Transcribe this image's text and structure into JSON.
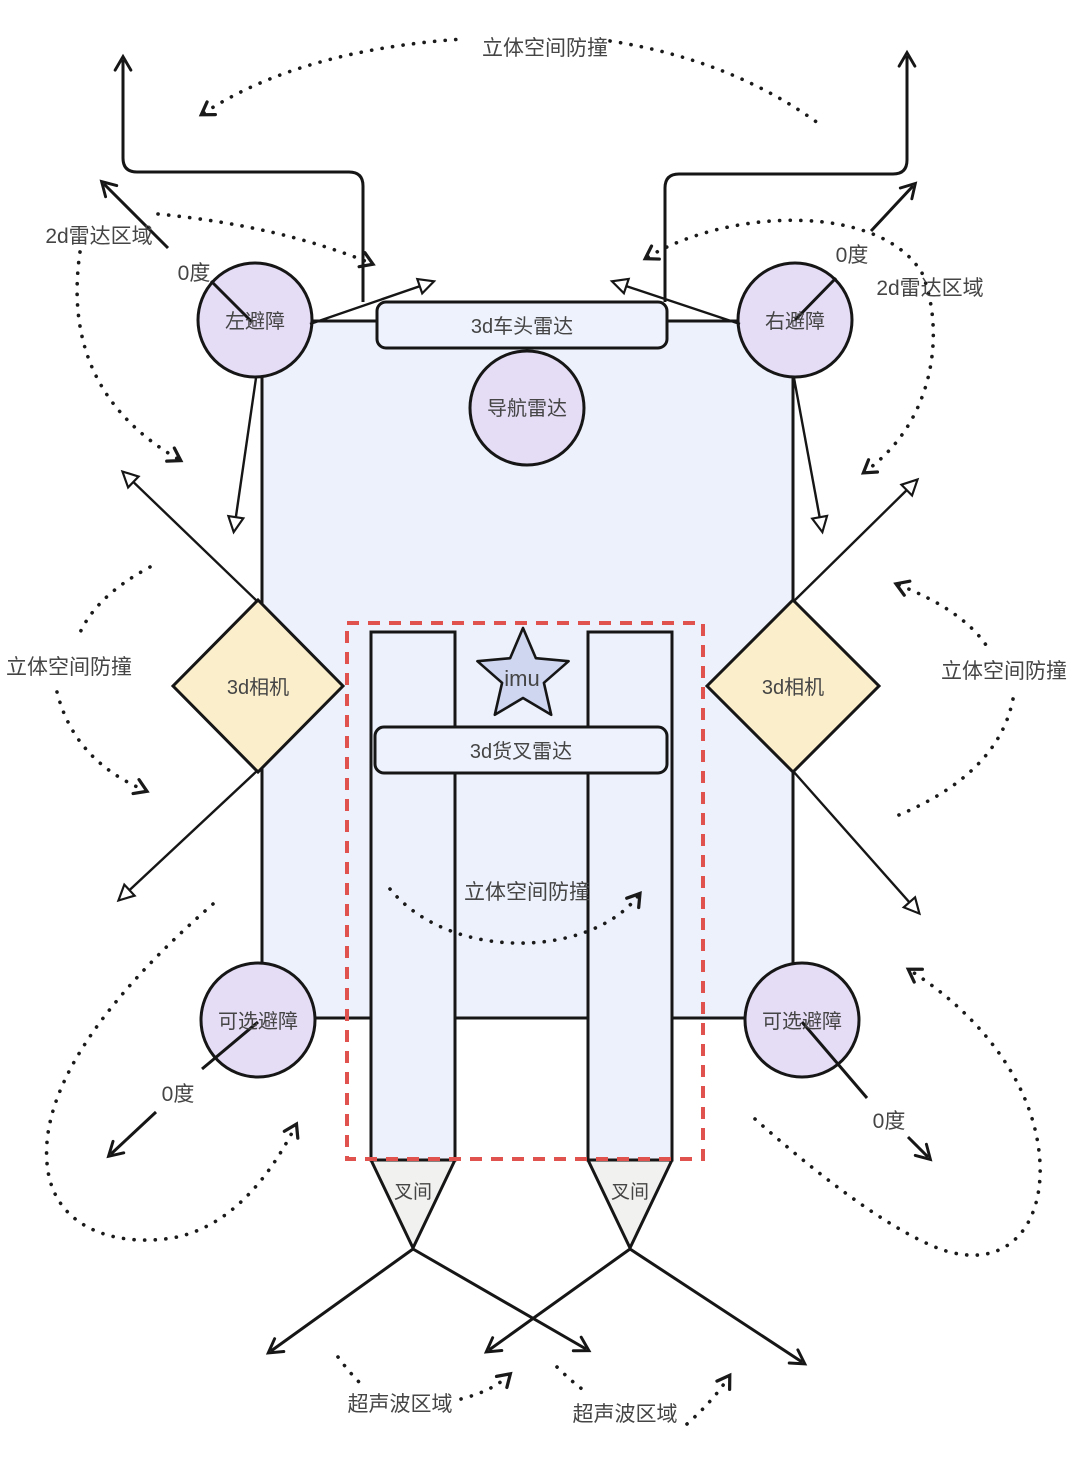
{
  "diagram": {
    "top": {
      "space_collision": "立体空间防撞",
      "radar2d_left": "2d雷达区域",
      "radar2d_right": "2d雷达区域",
      "zero_left": "0度",
      "zero_right": "0度"
    },
    "sensors": {
      "left_avoid": "左避障",
      "right_avoid": "右避障",
      "head_radar": "3d车头雷达",
      "nav_radar": "导航雷达",
      "camera_left": "3d相机",
      "camera_right": "3d相机",
      "imu": "imu",
      "fork_radar": "3d货叉雷达",
      "optional_left": "可选避障",
      "optional_right": "可选避障"
    },
    "middle": {
      "space_left": "立体空间防撞",
      "space_right": "立体空间防撞",
      "space_fork": "立体空间防撞"
    },
    "bottom": {
      "zero_left": "0度",
      "zero_right": "0度",
      "fork_gap_left": "叉间",
      "fork_gap_right": "叉间",
      "ultrasonic_left": "超声波区域",
      "ultrasonic_right": "超声波区域"
    }
  },
  "colors": {
    "body": "#edf1fb",
    "panel": "#eef2fc",
    "node": "#e5dcf6",
    "camera": "#fbeecb",
    "star": "#ced6f0",
    "fork_tip": "#f1f1ef",
    "dashed": "#e0524d",
    "line": "#161616",
    "text": "#454545"
  }
}
